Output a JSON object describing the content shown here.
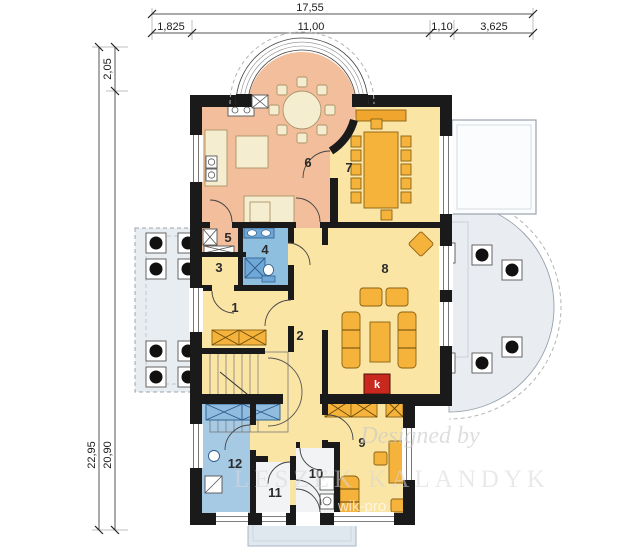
{
  "dimensions": {
    "top": {
      "total": "17,55",
      "segments": [
        "1,825",
        "11,00",
        "1,10",
        "3,625"
      ]
    },
    "left": {
      "upper": "2,05",
      "outer": "22,95",
      "inner": "20,90"
    }
  },
  "rooms": {
    "r1": "1",
    "r2": "2",
    "r3": "3",
    "r4": "4",
    "r5": "5",
    "r6": "6",
    "r7": "7",
    "r8": "8",
    "r9": "9",
    "r10": "10",
    "r11": "11",
    "r12": "12"
  },
  "fireplace": {
    "label": "k"
  },
  "watermark": {
    "script": "Designed by",
    "name": "LESZEK KALANDYK",
    "fragment": "wik-pro"
  },
  "colors": {
    "wall": "#1a1a1a",
    "room_salmon": "#F2BE9B",
    "room_yellow": "#FAE5A4",
    "bath_blue": "#8FBFDF",
    "room_blue": "#A6C9E4",
    "furniture_orange": "#F5B33C",
    "furniture_cream": "#F5EDCF",
    "terrace": "#E9EDF2",
    "fireplace_red": "#C9281E"
  }
}
